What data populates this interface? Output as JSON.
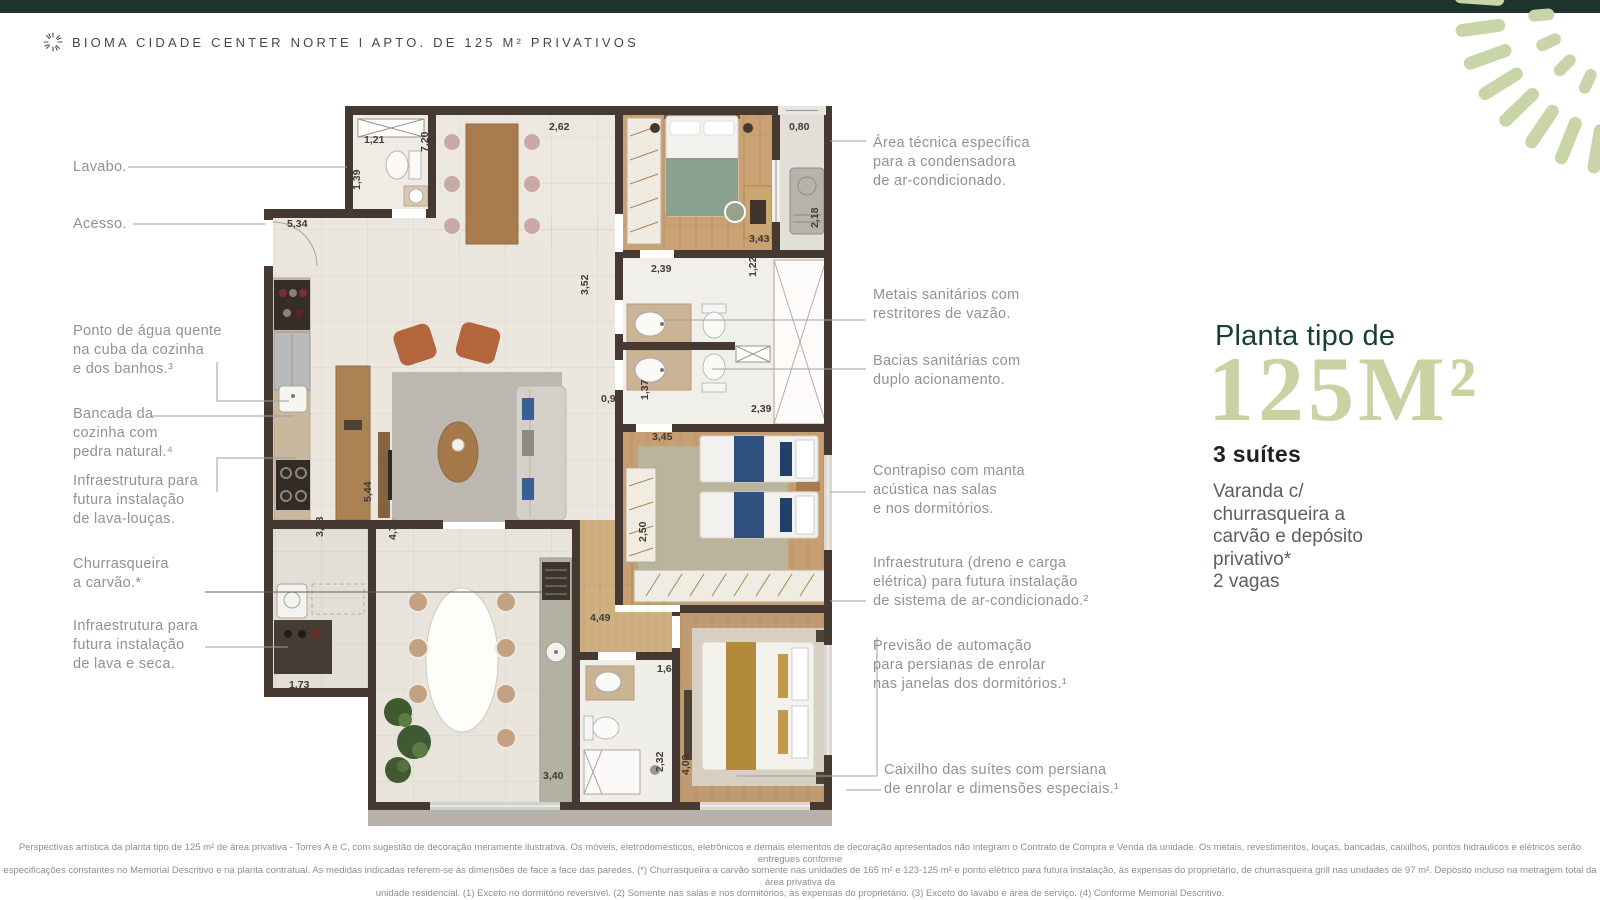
{
  "colors": {
    "topbar": "#1d332b",
    "accent": "#17412f",
    "sage": "#c9d5a8",
    "bignum": "#c8d2a2"
  },
  "header": {
    "title": "BIOMA CIDADE CENTER NORTE I APTO. DE 125 M² PRIVATIVOS",
    "logo": "sunburst-icon"
  },
  "callouts_left": [
    {
      "id": "lavabo",
      "text": "Lavabo."
    },
    {
      "id": "acesso",
      "text": "Acesso."
    },
    {
      "id": "ponto-agua",
      "text": "Ponto de água quente\nna cuba da cozinha\ne dos banhos.³"
    },
    {
      "id": "bancada",
      "text": "Bancada da\ncozinha com\npedra natural.⁴"
    },
    {
      "id": "lava-loucas",
      "text": "Infraestrutura para\nfutura instalação\nde lava-louças."
    },
    {
      "id": "churrasqueira",
      "text": "Churrasqueira\na carvão.*"
    },
    {
      "id": "lava-seca",
      "text": "Infraestrutura para\nfutura instalação\nde lava e seca."
    }
  ],
  "callouts_right": [
    {
      "id": "area-tecnica",
      "text": "Área técnica específica\npara a condensadora\nde ar-condicionado."
    },
    {
      "id": "metais",
      "text": "Metais sanitários com\nrestritores de vazão."
    },
    {
      "id": "bacias",
      "text": "Bacias sanitárias com\nduplo acionamento."
    },
    {
      "id": "contrapiso",
      "text": "Contrapiso com manta\nacústica nas salas\ne nos dormitórios."
    },
    {
      "id": "dreno",
      "text": "Infraestrutura (dreno e carga\nelétrica) para futura instalação\nde sistema de ar-condicionado.²"
    },
    {
      "id": "previsao",
      "text": "Previsão de automação\npara persianas de enrolar\nnas janelas dos dormitórios.¹"
    },
    {
      "id": "caixilho",
      "text": "Caixilho das suítes com persiana\nde enrolar e dimensões especiais.¹"
    }
  ],
  "panel": {
    "kicker": "Planta tipo de",
    "area": "125M²",
    "suites": "3 suítes",
    "desc": "Varanda c/\nchurrasqueira a\ncarvão e depósito\nprivativo*\n2 vagas"
  },
  "plan": {
    "dimensions": [
      "1,21",
      "7,20",
      "2,62",
      "0,80",
      "1,39",
      "5,34",
      "3,43",
      "2,18",
      "2,39",
      "1,22",
      "3,52",
      "0,94",
      "1,37",
      "2,39",
      "3,45",
      "5,44",
      "3,03",
      "4,74",
      "2,50",
      "4,49",
      "1,73",
      "1,64",
      "2,32",
      "4,03",
      "3,40"
    ]
  },
  "footer": {
    "disclaimer": "Perspectivas artística da planta tipo de 125 m² de área privativa - Torres A e C, com sugestão de decoração meramente ilustrativa. Os móveis, eletrodomésticos, eletrônicos e demais elementos de decoração apresentados não integram o Contrato de Compra e Venda da unidade. Os metais, revestimentos, louças, bancadas, caixilhos, pontos hidráulicos e elétricos serão entregues conforme\nespecificações constantes no Memorial Descritivo e na planta contratual. As medidas indicadas referem-se às dimensões de face a face das paredes. (*) Churrasqueira a carvão somente nas unidades de 165 m² e 123-125 m² e ponto elétrico para futura instalação, às expensas do proprietário, de churrasqueira grill nas unidades de 97 m². Depósito incluso na metragem total da área privativa da\nunidade residencial. (1) Exceto no dormitório reversível. (2) Somente nas salas e nos dormitórios, às expensas do proprietário. (3) Exceto do lavabo e área de serviço. (4) Conforme Memorial Descritivo."
  }
}
